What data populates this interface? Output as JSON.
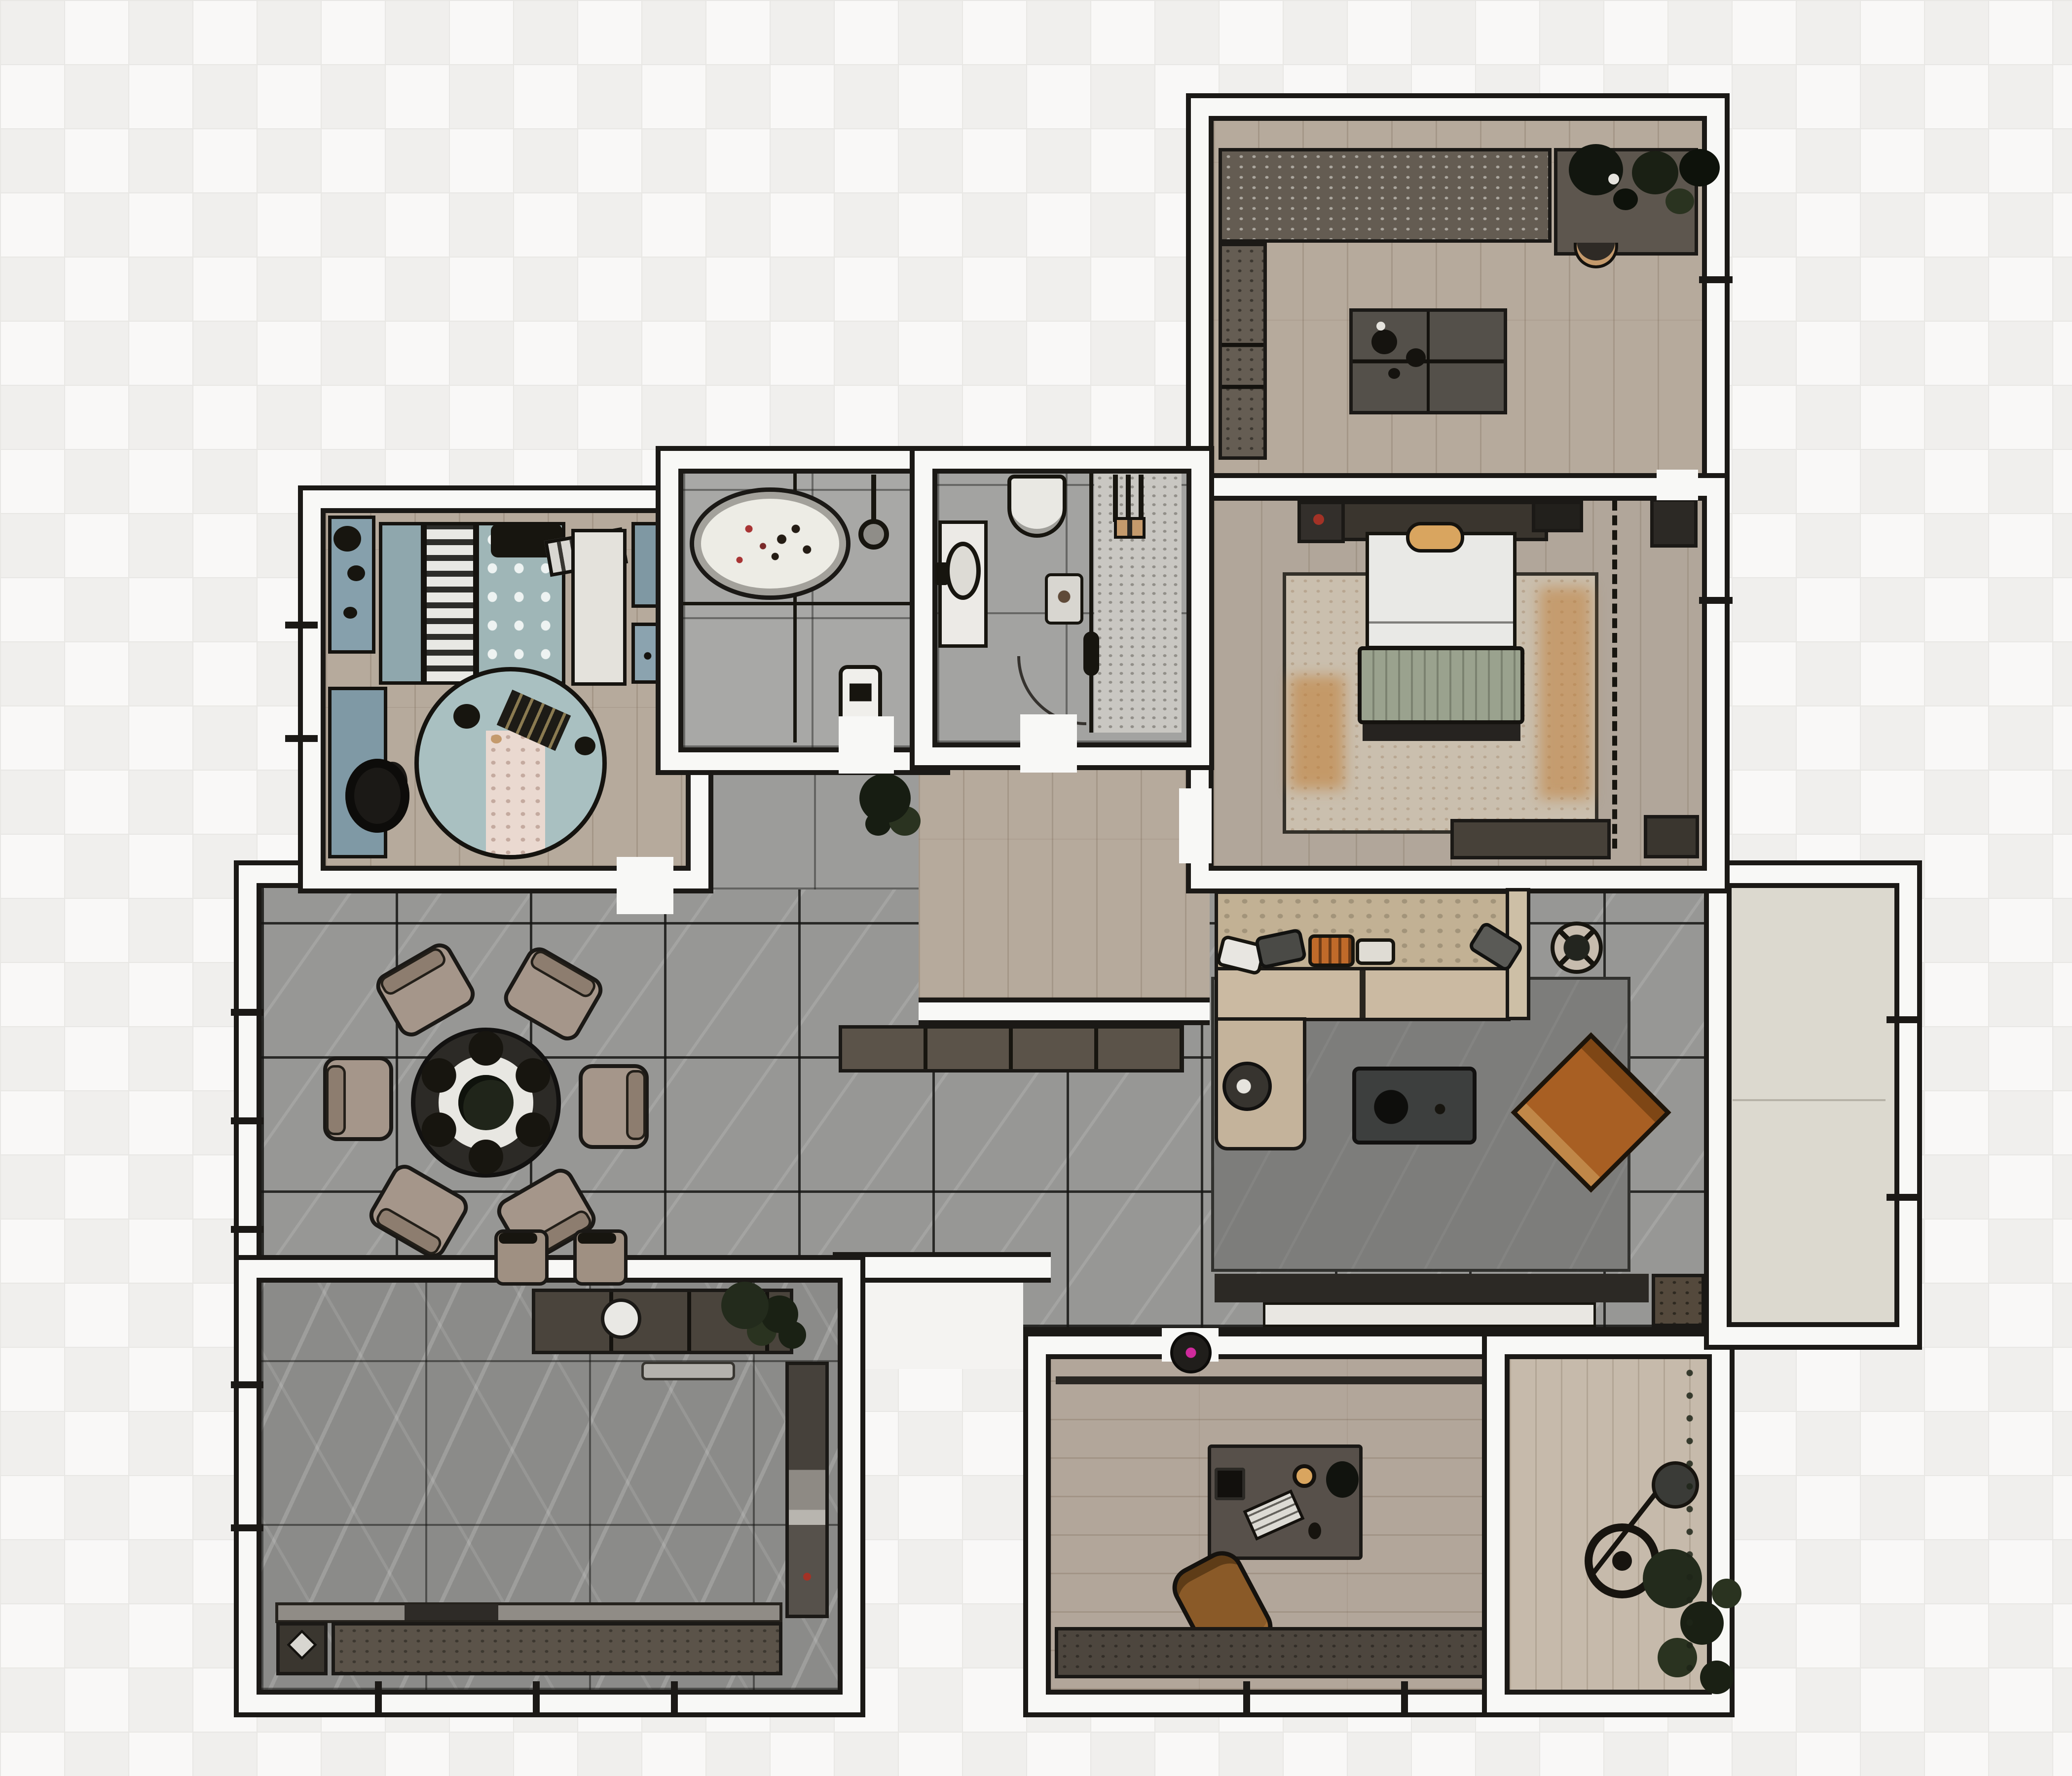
{
  "document": {
    "type": "interior-floor-plan",
    "view": "top-down",
    "style": "rendered 2D plan, no text labels"
  },
  "palette": {
    "bg": "#f4f3f1",
    "bggrid": "#e8e7e4",
    "wall": "#f8f8f6",
    "line": "#1b1916",
    "wood": "#b6aa9c",
    "wood2": "#b1a69a",
    "wood3": "#b2a69a",
    "deck": "#c6baab",
    "hall": "#979795",
    "kit": "#8b8b89",
    "bath": "#a8a8a6",
    "shower": "#c9c7c2",
    "balc": "#dcd9cf",
    "teal": "#7f98a5",
    "teal2": "#9fb6b7",
    "krug": "#a9c0c1",
    "krugc": "#ead9d0",
    "lrug": "#7d7d7b",
    "brug": "#cabfae",
    "orange": "#bf7a30",
    "sofa": "#c2b194",
    "seat": "#cbbaa2",
    "leather": "#a85f23",
    "cab": "#4c463e",
    "cab2": "#5b5349",
    "cab3": "#35312b",
    "white": "#eceae6",
    "sage": "#9aa28e",
    "gold": "#d9a55f",
    "plant": "#232b1c",
    "mag": "#cf2a9c",
    "red": "#a33226"
  },
  "rooms": [
    {
      "id": "walk-in-closet",
      "position": "top-right",
      "floor": "wood-planks",
      "furniture": [
        "wardrobe-row",
        "planter-box",
        "closet-cabinet-column",
        "island-dresser",
        "basin"
      ]
    },
    {
      "id": "master-bedroom",
      "position": "right",
      "floor": "wood-planks",
      "furniture": [
        "double-bed",
        "headboard-with-nightstands",
        "accent-pillow",
        "sage-throw",
        "foot-bench",
        "area-rug-orange-wash",
        "speaker-side-table",
        "wall-tv",
        "closet-unit",
        "wardrobe-dashed-outline",
        "tv-console",
        "door-mat"
      ]
    },
    {
      "id": "kids-bedroom",
      "position": "left",
      "floor": "wood-planks",
      "furniture": [
        "kids-bed-teal-dot-duvet",
        "pattern-blanket",
        "pillow-row",
        "stripe-pillow",
        "toy-shelf",
        "desk-teal",
        "desk-chair",
        "round-rug",
        "toys",
        "wardrobe-white",
        "cabinet-teal",
        "cabinet-teal-low"
      ]
    },
    {
      "id": "bathroom",
      "position": "center-top",
      "floor": "stone-tile",
      "furniture": [
        "freestanding-oval-bathtub",
        "flower-petals",
        "shower-head",
        "glass-partition",
        "laundry-appliance"
      ]
    },
    {
      "id": "shower-room",
      "position": "center-top",
      "floor": "stone-tile",
      "furniture": [
        "toilet",
        "vanity-with-sink",
        "bath-mat",
        "walk-in-shower",
        "shower-fixture",
        "door-swing"
      ]
    },
    {
      "id": "living-dining-hall",
      "position": "center",
      "floor": "marble-tile",
      "furniture": [
        "round-dining-table",
        "dining-chairs-x6",
        "place-settings",
        "bar-stools-x2",
        "sideboard",
        "corner-plant",
        "sectional-sofa",
        "chaise-lounge",
        "sofa-cushions",
        "round-side-table",
        "coffee-table",
        "leather-lounge-chair",
        "plant-stand",
        "living-rug",
        "media-wall-strip",
        "tv-lowboard-white",
        "corner-cabinet",
        "robot-vacuum"
      ]
    },
    {
      "id": "kitchen",
      "position": "bottom-left",
      "floor": "dark-stone-tile",
      "furniture": [
        "bar-counter",
        "counter-sink",
        "counter-plants",
        "floor-mat",
        "countertop-strip",
        "cooktop-recess",
        "base-cabinet-run",
        "diamond-motif-unit",
        "tall-cabinet-column"
      ]
    },
    {
      "id": "study",
      "position": "bottom-right",
      "floor": "wood-planks",
      "furniture": [
        "wall-rail",
        "desk",
        "desk-speaker",
        "desk-lamp",
        "desk-plant",
        "keyboard",
        "office-chair",
        "sideboard"
      ]
    },
    {
      "id": "garden-strip",
      "position": "bottom-right-edge",
      "floor": "deck-boards",
      "furniture": [
        "arc-floor-lamp",
        "lamp-base-rings",
        "potted-plants",
        "plant-fringe"
      ]
    },
    {
      "id": "balcony",
      "position": "right-edge",
      "floor": "screed",
      "furniture": [
        "floor-seam",
        "window-mullions"
      ]
    },
    {
      "id": "corridor",
      "position": "center",
      "floor": "wood-planks",
      "furniture": [
        "plant-nook"
      ]
    },
    {
      "id": "entry-void",
      "position": "bottom-center",
      "floor": "none",
      "furniture": []
    }
  ]
}
